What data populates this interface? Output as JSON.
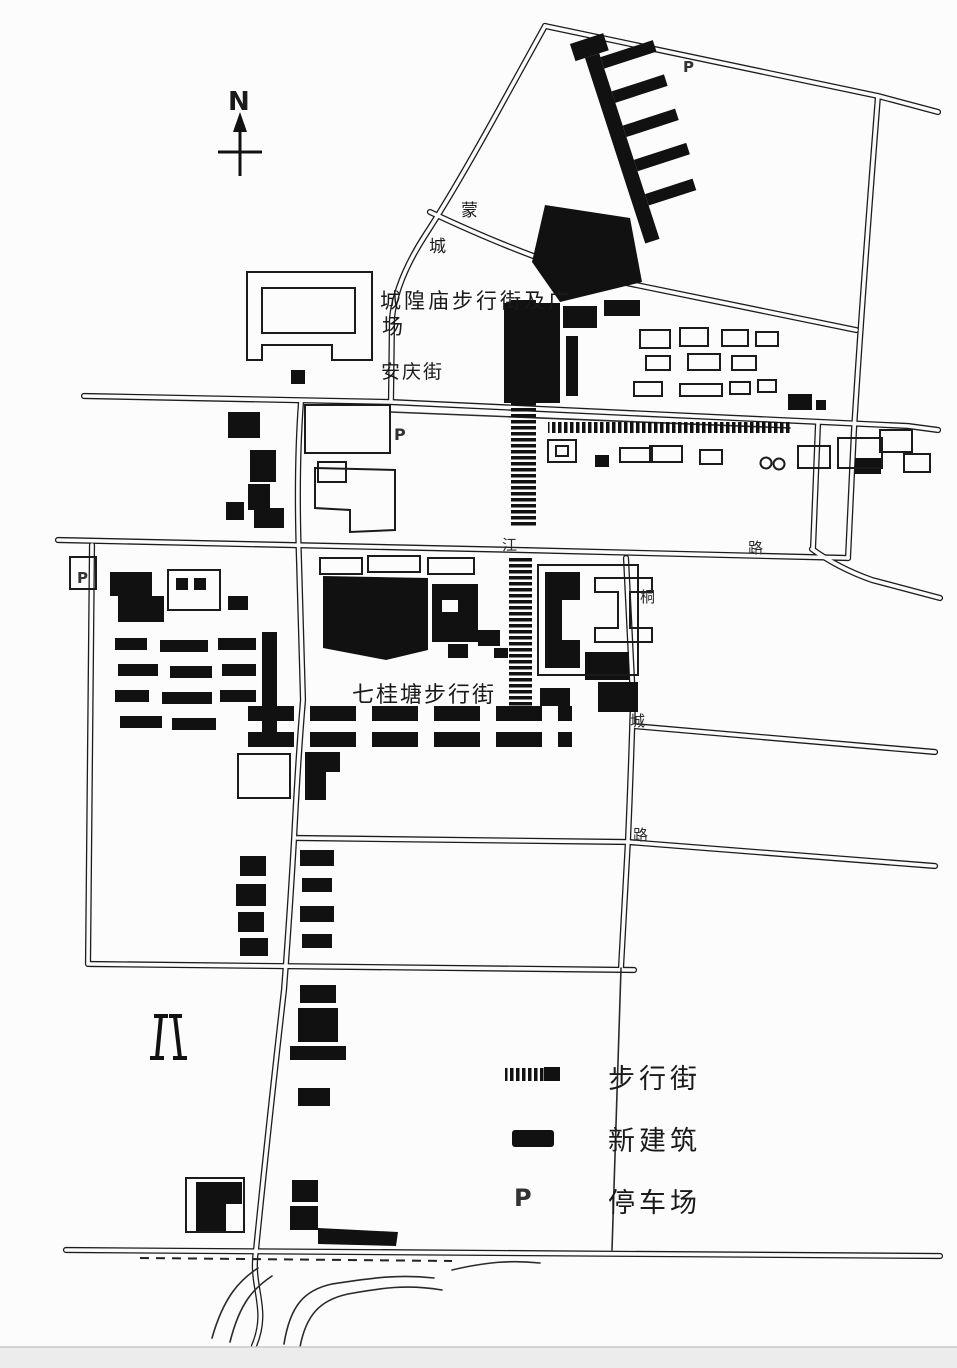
{
  "map": {
    "north_letter": "N",
    "labels": {
      "chenghuangmiao_line1": "城隍庙步行街及广",
      "chenghuangmiao_line2": "场",
      "anqing_street": "安庆街",
      "mengcheng_char_1": "蒙",
      "mengcheng_char_2": "城",
      "qiguitang": "七桂塘步行街",
      "jiang_char": "江",
      "changjiang_lu_char": "路",
      "tong_char": "桐",
      "cheng_char": "城",
      "tongcheng_lu_char": "路",
      "parking_top": "P",
      "parking_center": "P",
      "parking_left": "P"
    },
    "legend": {
      "items": [
        {
          "symbol": "hatched-bar",
          "label": "步行街"
        },
        {
          "symbol": "black-block",
          "label": "新建筑"
        },
        {
          "symbol": "letter-p",
          "symbol_text": "P",
          "label": "停车场"
        }
      ]
    },
    "colors": {
      "ink": "#1a1a1a",
      "paper": "#fcfcfc"
    }
  }
}
